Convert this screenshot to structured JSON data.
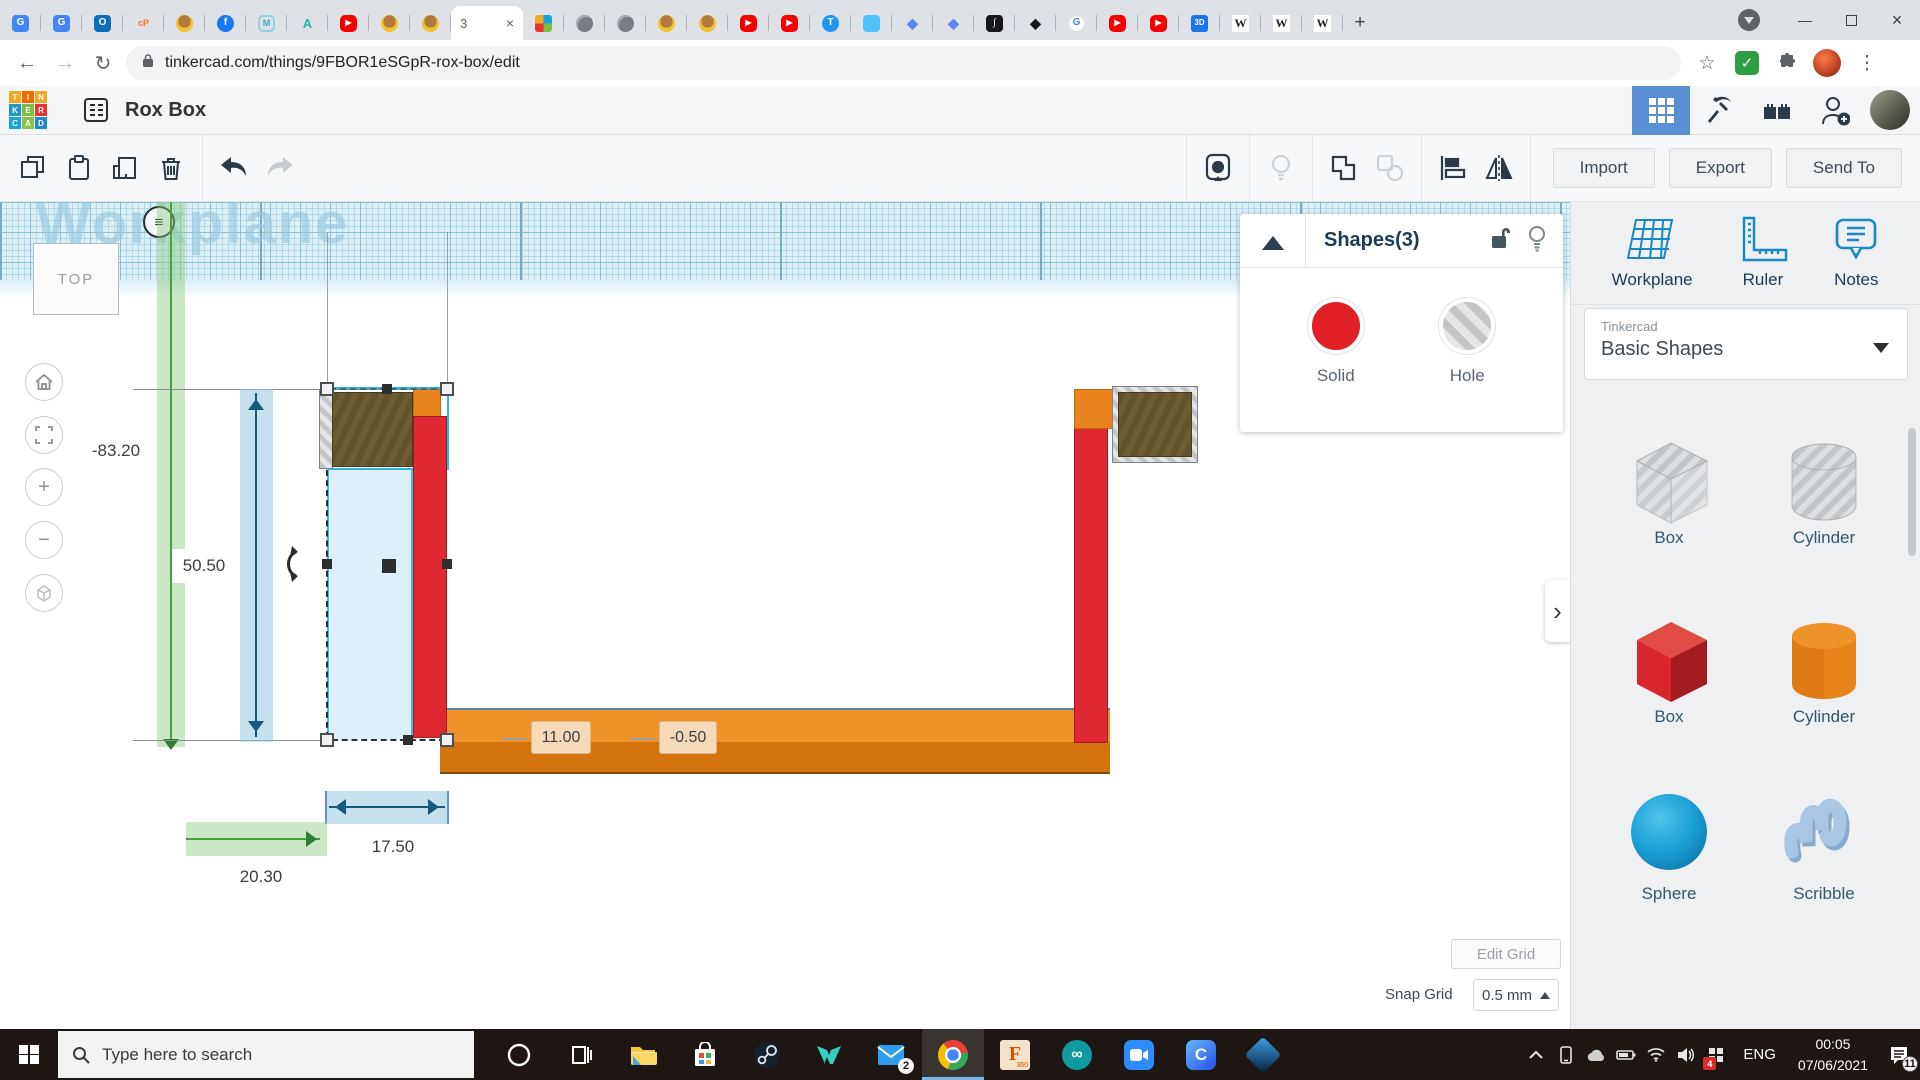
{
  "browser": {
    "tabs_left": [
      {
        "n": "translate",
        "g": "G"
      },
      {
        "n": "translate",
        "g": "G"
      },
      {
        "n": "outlook",
        "g": "O"
      },
      {
        "n": "cpanel",
        "g": "cP"
      },
      {
        "n": "bot",
        "g": ""
      },
      {
        "n": "facebook",
        "g": "f"
      },
      {
        "n": "hex",
        "g": "M"
      },
      {
        "n": "autodesk",
        "g": "A"
      },
      {
        "n": "youtube",
        "g": "▶"
      },
      {
        "n": "bot",
        "g": ""
      },
      {
        "n": "bot",
        "g": ""
      }
    ],
    "active_tab": {
      "title": "3",
      "close": "×"
    },
    "tabs_right": [
      {
        "n": "tinkercad",
        "g": ""
      },
      {
        "n": "globe",
        "g": ""
      },
      {
        "n": "globe",
        "g": ""
      },
      {
        "n": "bot",
        "g": ""
      },
      {
        "n": "bot",
        "g": ""
      },
      {
        "n": "youtube",
        "g": "▶"
      },
      {
        "n": "youtube",
        "g": "▶"
      },
      {
        "n": "tcircle",
        "g": "T"
      },
      {
        "n": "robot",
        "g": ""
      },
      {
        "n": "docs",
        "g": "◆"
      },
      {
        "n": "docs",
        "g": "◆"
      },
      {
        "n": "jmono",
        "g": "∫"
      },
      {
        "n": "inkscape",
        "g": "◆"
      },
      {
        "n": "google",
        "g": "G"
      },
      {
        "n": "youtube",
        "g": "▶"
      },
      {
        "n": "youtube",
        "g": "▶"
      },
      {
        "n": "threed",
        "g": "3D"
      },
      {
        "n": "wiki",
        "g": "W"
      },
      {
        "n": "wiki",
        "g": "W"
      },
      {
        "n": "wiki",
        "g": "W"
      }
    ],
    "glyphs": {
      "new_tab": "+",
      "minimize": "—",
      "close": "×",
      "back": "←",
      "forward": "→",
      "reload": "↻",
      "star": "☆",
      "menu": "⋮",
      "check": "✓",
      "hamburger": "≡",
      "chevron": "›",
      "plus": "+",
      "minus": "−",
      "infinity": "∞"
    },
    "url": "tinkercad.com/things/9FBOR1eSGpR-rox-box/edit"
  },
  "header": {
    "title": "Rox Box",
    "logo_letters": [
      "T",
      "I",
      "N",
      "K",
      "E",
      "R",
      "C",
      "A",
      "D"
    ],
    "logo_colors": [
      "#f5a623",
      "#ef6c00",
      "#f5a623",
      "#2196c9",
      "#7ac143",
      "#e8342e",
      "#16a3d8",
      "#8bc34a",
      "#1e88c9"
    ]
  },
  "toolbar": {
    "import_label": "Import",
    "export_label": "Export",
    "send_to_label": "Send To"
  },
  "shapes_panel": {
    "title": "Shapes(3)",
    "solid_label": "Solid",
    "hole_label": "Hole",
    "solid_color": "#e11f26"
  },
  "sidebar": {
    "tools": [
      {
        "label": "Workplane"
      },
      {
        "label": "Ruler"
      },
      {
        "label": "Notes"
      }
    ],
    "brand": "Tinkercad",
    "library": "Basic Shapes",
    "shapes": [
      {
        "label": "Box"
      },
      {
        "label": "Cylinder"
      },
      {
        "label": "Box"
      },
      {
        "label": "Cylinder"
      },
      {
        "label": "Sphere"
      },
      {
        "label": "Scribble"
      }
    ]
  },
  "canvas": {
    "watermark": "Workplane",
    "view_cube": "TOP",
    "dims": {
      "offset_y": "-83.20",
      "height": "50.50",
      "width_a": "11.00",
      "width_b": "-0.50",
      "sel_width": "17.50",
      "offset_x": "20.30"
    }
  },
  "grid_controls": {
    "edit_label": "Edit Grid",
    "snap_label": "Snap Grid",
    "snap_value": "0.5 mm"
  },
  "taskbar": {
    "search_placeholder": "Type here to search",
    "language": "ENG",
    "clock": {
      "time": "00:05",
      "date": "07/06/2021"
    },
    "badges": {
      "mail": "2",
      "tray": "4",
      "notifications": "11"
    },
    "fusion": {
      "label": "F",
      "sub": "360"
    },
    "arduino_glyph": "∞",
    "clipchamp_glyph": "C"
  }
}
